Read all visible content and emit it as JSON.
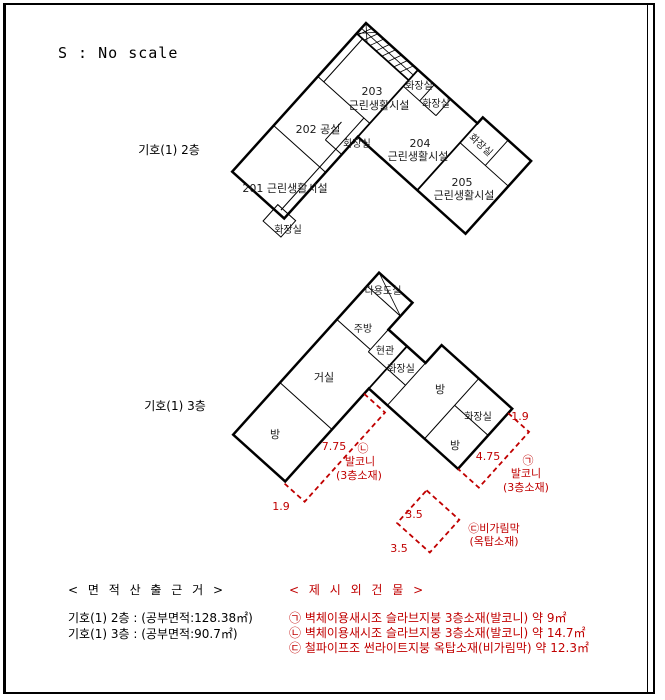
{
  "scale_note": "S : No scale",
  "colors": {
    "ink": "#000000",
    "red": "#c00000"
  },
  "floor2": {
    "caption": "기호(1) 2층",
    "room201": "201 근린생활시설",
    "room202": "202 공실",
    "room203_no": "203",
    "room203_name": "근린생활시설",
    "room204_no": "204",
    "room204_name": "근린생활시설",
    "room205_no": "205",
    "room205_name": "근린생활시설",
    "toilet": "화장실"
  },
  "floor3": {
    "caption": "기호(1) 3층",
    "utility": "다용도실",
    "kitchen": "주방",
    "entrance": "현관",
    "toilet": "화장실",
    "living": "거실",
    "room": "방"
  },
  "annotations": {
    "balcony_right": {
      "mark": "㉠",
      "name": "발코니",
      "loc": "(3층소재)",
      "width": "1.9",
      "length": "4.75"
    },
    "balcony_left": {
      "mark": "㉡",
      "name": "발코니",
      "loc": "(3층소재)",
      "width": "1.9",
      "length": "7.75"
    },
    "canopy": {
      "name": "㉢비가림막",
      "loc": "(옥탑소재)",
      "side_a": "3.5",
      "side_b": "3.5"
    }
  },
  "legend": {
    "area_title": "< 면 적 산 출 근 거 >",
    "area_lines": [
      "기호(1) 2층 : (공부면적:128.38㎡)",
      "기호(1) 3층 : (공부면적:90.7㎡)"
    ],
    "extra_title": "< 제 시 외 건 물 >",
    "extra_lines": [
      "㉠ 벽체이용새시조 슬라브지붕 3층소재(발코니) 약 9㎡",
      "㉡ 벽체이용새시조 슬라브지붕 3층소재(발코니) 약 14.7㎡",
      "㉢ 철파이프조 썬라이트지붕 옥탑소재(비가림막) 약 12.3㎡"
    ]
  }
}
